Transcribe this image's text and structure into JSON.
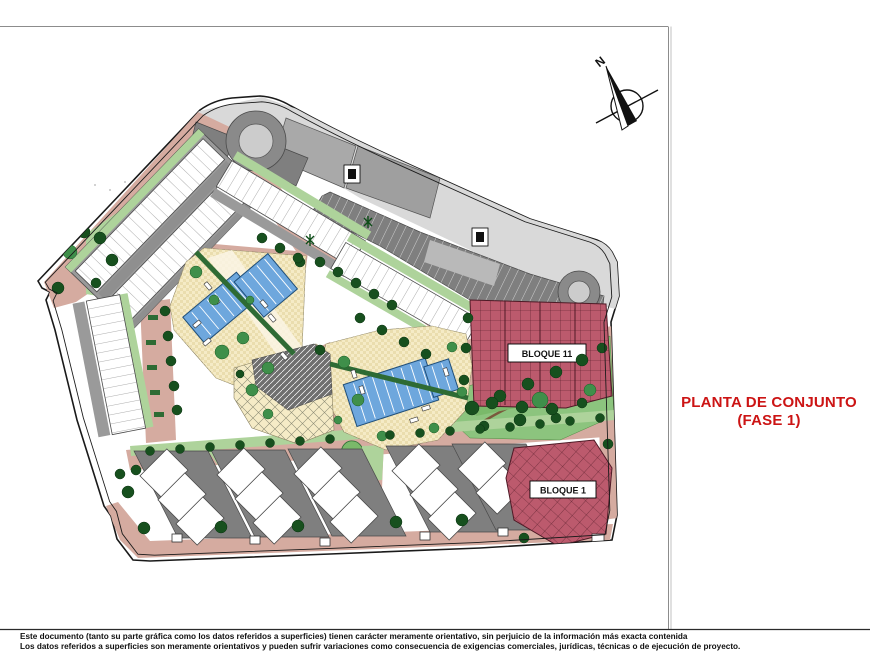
{
  "title": {
    "line1": "PLANTA DE CONJUNTO",
    "line2": "(FASE 1)"
  },
  "plan": {
    "north_label": "N",
    "bloque11_label": "BLOQUE 11",
    "bloque1_label": "BLOQUE 1"
  },
  "footer": {
    "line1": "Este documento (tanto su parte gráfica como los datos referidos a superficies) tienen carácter meramente orientativo, sin perjuicio de la información más exacta contenida",
    "line2": "Los datos referidos a superficies son meramente orientativos y pueden sufrir variaciones como consecuencia de exigencias comerciales, jurídicas, técnicas o de ejecución de proyecto."
  },
  "colors": {
    "accent": "#cc1414",
    "road": "#d5aba0",
    "plaza": "#f5ebc6",
    "plaza_check": "#e7d9a8",
    "pool": "#6ea7dd",
    "pool_edge": "#1f4e79",
    "green_light": "#aed39b",
    "green_mid": "#7ab96a",
    "green_park": "#8cc47e",
    "tree_dark": "#17501e",
    "tree_mid": "#3f8f4a",
    "hedge": "#2e6b34",
    "block_red": "#bc5a6d",
    "block_red_line": "#4f1a26",
    "parking": "#7f7f7f",
    "gray_mid": "#9a9a9a",
    "gray_light": "#d9d9d9",
    "outline": "#1a1a1a"
  }
}
